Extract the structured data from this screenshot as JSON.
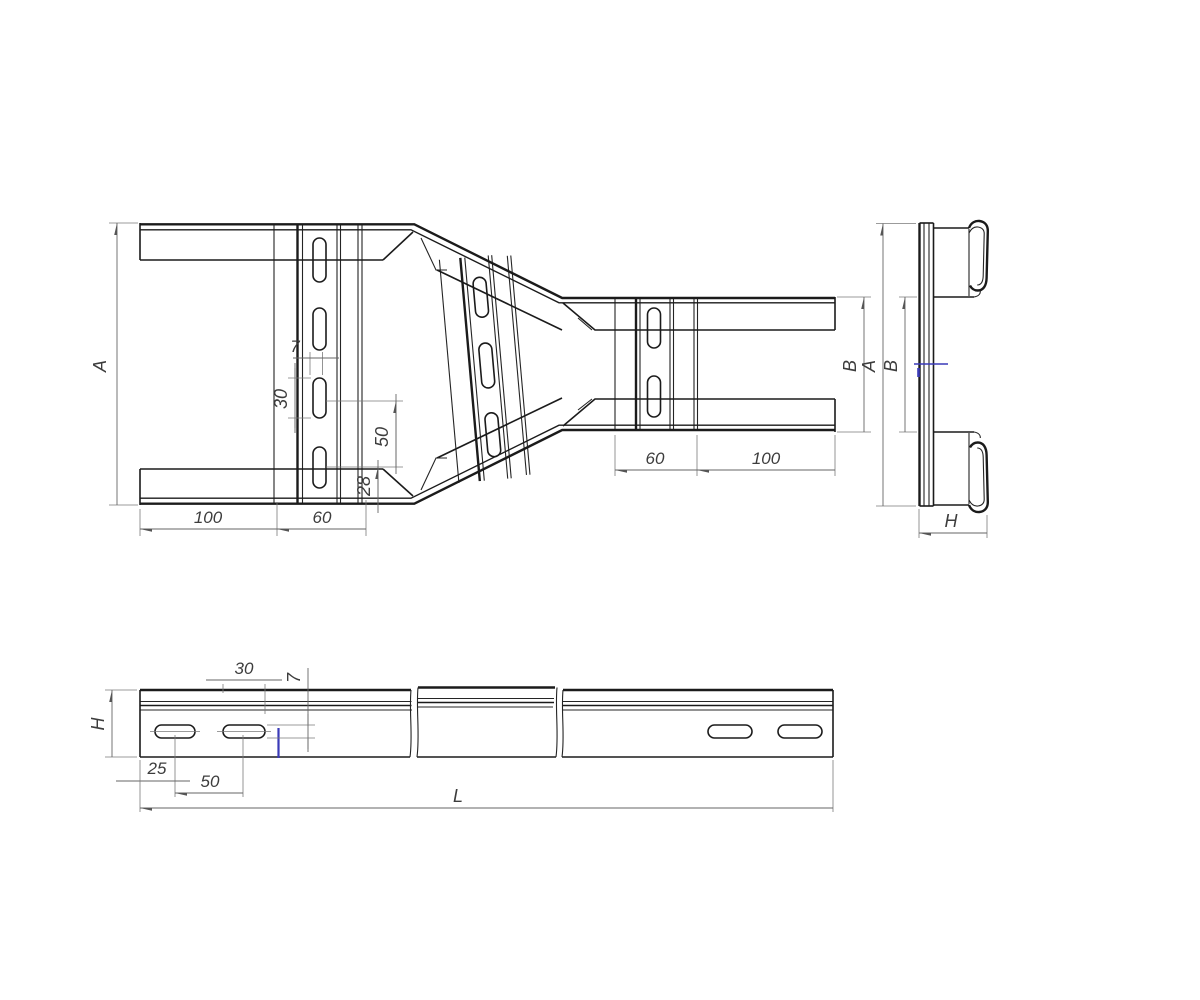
{
  "app": {
    "type": "cable-tray-reducer-technical-drawing",
    "background": "#ffffff"
  },
  "colors": {
    "geometry": "#1b1b1b",
    "dimension": "#666666",
    "accent_blue": "#3a3ab8"
  },
  "plan_view": {
    "dim_height_wide": "A",
    "dim_slot_width": "7",
    "dim_slot_length": "30",
    "dim_slot_pitch": "50",
    "dim_slot_edge_offset": "28",
    "dim_left_section": "100",
    "dim_wide_rung": "60",
    "dim_height_narrow": "B",
    "dim_narrow_rung": "60",
    "dim_right_section": "100"
  },
  "end_view": {
    "dim_height": "A",
    "dim_inner_height": "B",
    "dim_width": "H"
  },
  "side_view": {
    "dim_height": "H",
    "dim_slot_length": "30",
    "dim_slot_width": "7",
    "dim_end_offset": "25",
    "dim_slot_pitch": "50",
    "dim_length": "L"
  }
}
